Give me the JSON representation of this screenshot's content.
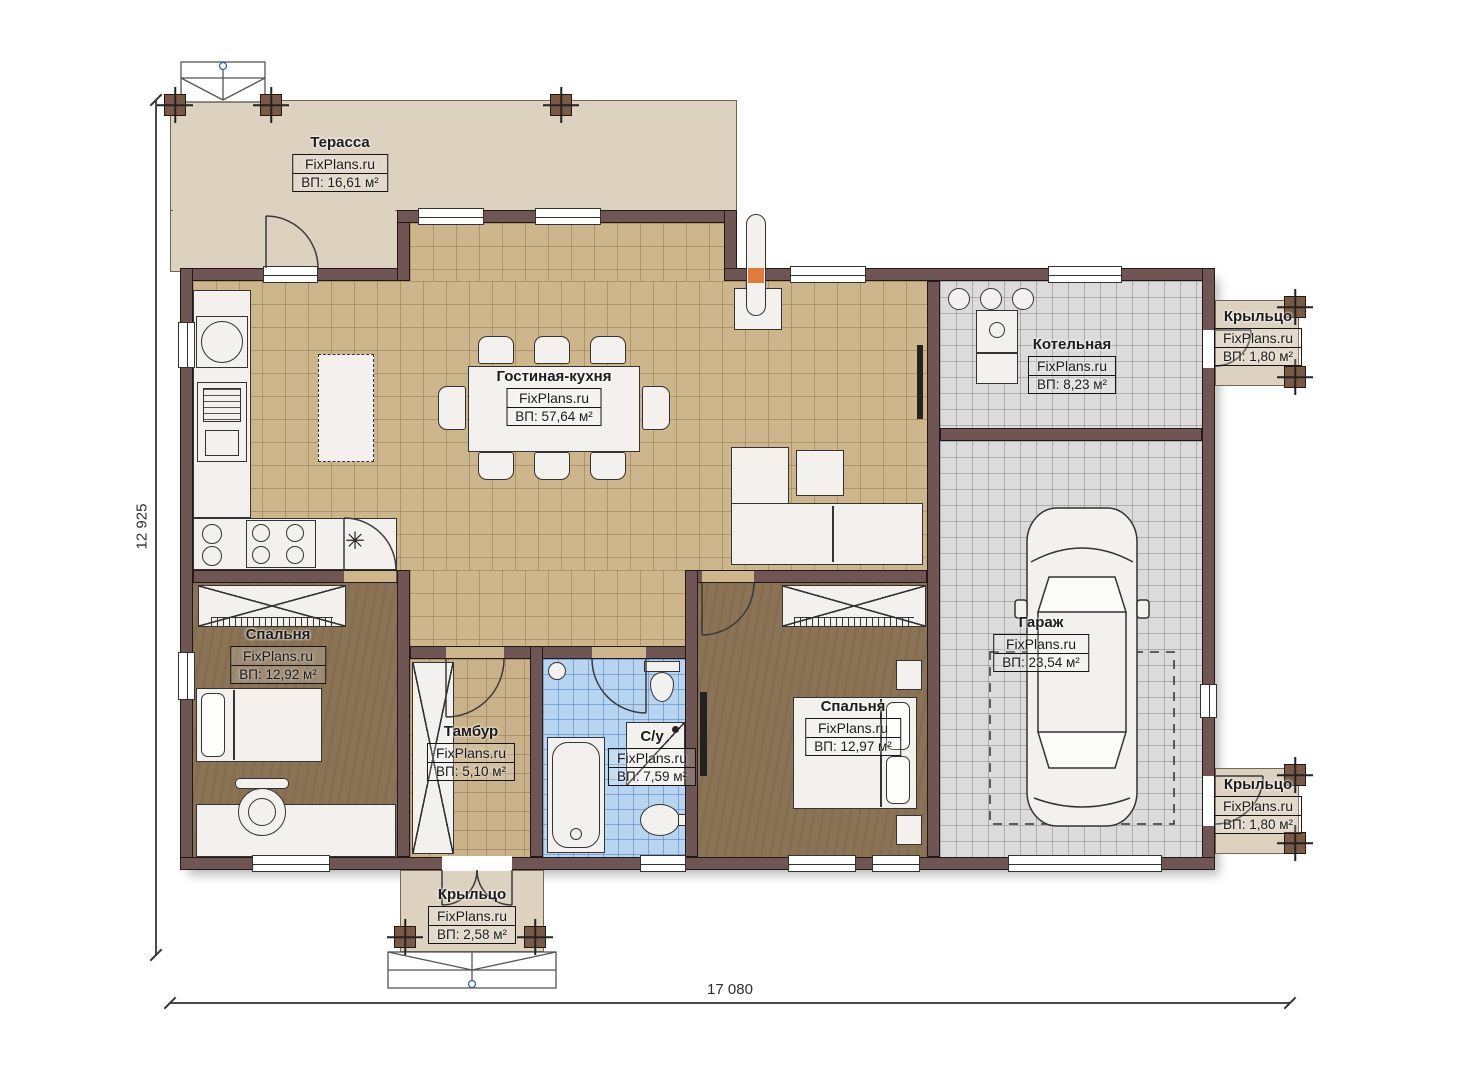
{
  "watermark": "FixPlans.ru",
  "icons": {
    "hob": "✳"
  },
  "dimensions": {
    "vertical": "12 925",
    "horizontal": "17 080"
  },
  "rooms": {
    "terrace": {
      "name": "Терасса",
      "area": "ВП: 16,61 м²"
    },
    "living_kitchen": {
      "name": "Гостиная-кухня",
      "area": "ВП: 57,64 м²"
    },
    "boiler": {
      "name": "Котельная",
      "area": "ВП: 8,23 м²"
    },
    "porch_top_right": {
      "name": "Крыльцо",
      "area": "ВП: 1,80 м²"
    },
    "garage": {
      "name": "Гараж",
      "area": "ВП: 23,54 м²"
    },
    "porch_bottom_right": {
      "name": "Крыльцо",
      "area": "ВП: 1,80 м²"
    },
    "bedroom_left": {
      "name": "Спальня",
      "area": "ВП: 12,92 м²"
    },
    "vestibule": {
      "name": "Тамбур",
      "area": "ВП: 5,10 м²"
    },
    "bathroom": {
      "name": "С/у",
      "area": "ВП: 7,59 м²"
    },
    "bedroom_right": {
      "name": "Спальня",
      "area": "ВП: 12,97 м²"
    },
    "porch_bottom": {
      "name": "Крыльцо",
      "area": "ВП: 2,58 м²"
    }
  },
  "colors": {
    "wall": "#6f5654",
    "terrace": "#ddd1c0",
    "living_tile": "#cdb68c",
    "bedroom_floor": "#8b7355",
    "bathroom_tile": "#b7d4f0",
    "garage_tile": "#dbdbdb",
    "label_border": "#141414"
  }
}
